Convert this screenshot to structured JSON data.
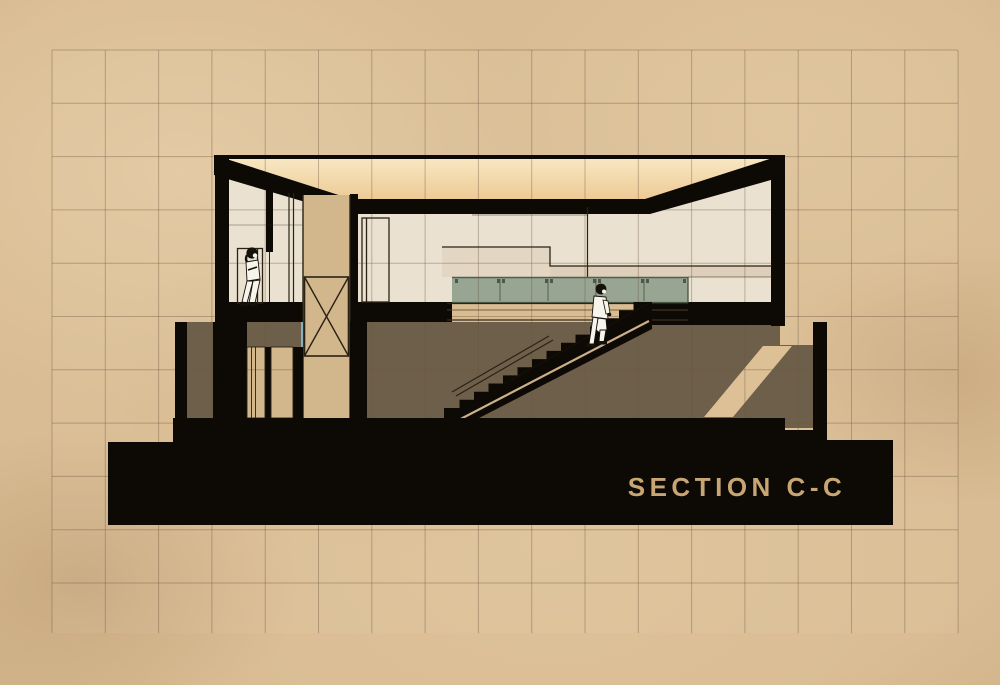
{
  "title": {
    "text": "SECTION C-C"
  },
  "drawing": {
    "kind": "architectural-section-elevation",
    "levels": [
      "upper-floor",
      "lower-floor",
      "base-plinth"
    ],
    "figures": [
      "woman-leaning-in-doorway",
      "man-climbing-stair"
    ]
  },
  "palette": {
    "paper": "#d9bc93",
    "ink": "#0d0a06",
    "cream": "#eae1d0",
    "cream_shade": "#ddcfba",
    "glow_top": "#f8e7c3",
    "glow_bottom": "#edca95",
    "teal": "#97a592",
    "teal_line": "#525e4c",
    "brown": "#6e5f4a",
    "tan": "#d2b68c",
    "stripe": "#ddc096",
    "wood": "#d9bd92",
    "blue_accent": "#86b0c2",
    "line": "#2a2214",
    "title_color": "#c8a673",
    "grid_line": "#6b543c"
  },
  "grid": {
    "x0": 52,
    "y0": 50,
    "x1": 958,
    "y1": 633,
    "spacing": 53.3
  }
}
